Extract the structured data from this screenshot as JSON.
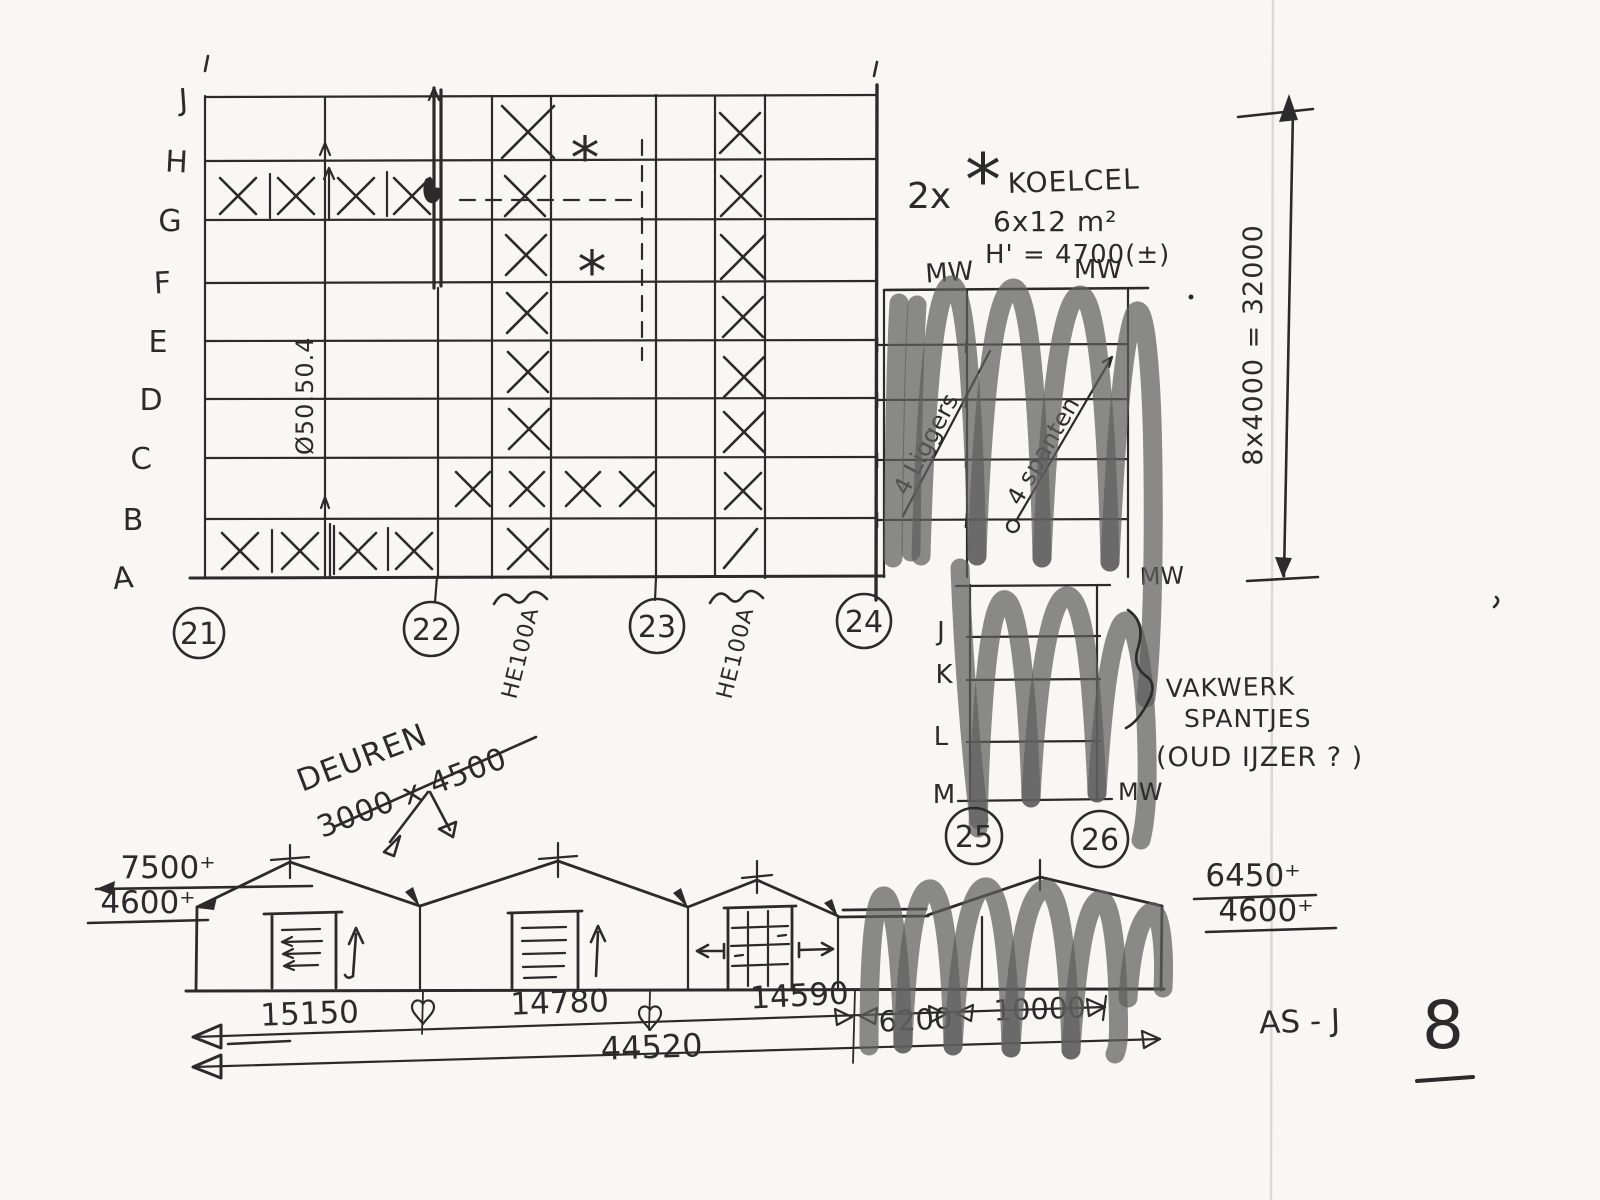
{
  "plan": {
    "row_labels": [
      "J",
      "H",
      "G",
      "F",
      "E",
      "D",
      "C",
      "B",
      "A"
    ],
    "axis_marks": [
      "21",
      "22",
      "23",
      "24"
    ],
    "asterisk_1": "*",
    "asterisk_2": "*",
    "profile_note": "Ø50.50.4",
    "beam_note_1": "HE100A",
    "beam_note_2": "HE100A"
  },
  "koelcel_note": {
    "qty": "2x",
    "star": "*",
    "name": "KOELCEL",
    "size": "6x12 m²",
    "height": "H' = 4700(±)"
  },
  "mid_grid": {
    "mw_left": "MW",
    "mw_right": "MW",
    "diag_note_1": "4 Liggers",
    "diag_note_2": "4 spanten"
  },
  "right_dim_label": "8x4000 = 32000",
  "lower_grid": {
    "row_labels": [
      "J",
      "K",
      "L",
      "M"
    ],
    "axis_marks": [
      "25",
      "26"
    ],
    "mw_top": "MW",
    "mw_bottom": "MW",
    "truss_note_1": "VAKWERK",
    "truss_note_2": "SPANTJES",
    "truss_note_3": "(OUD IJZER ? )"
  },
  "doors_note": {
    "line1": "DEUREN",
    "line2": "3000 x 4500"
  },
  "elevation": {
    "level_left_1": "7500⁺",
    "level_left_2": "4600⁺",
    "level_right_1": "6450⁺",
    "level_right_2": "4600⁺",
    "dim_1": "15150",
    "dim_2": "14780",
    "dim_3": "14590",
    "dim_4": "6200",
    "dim_5": "10000",
    "dim_total": "44520",
    "axis_note": "AS - J"
  },
  "page_number": "8"
}
